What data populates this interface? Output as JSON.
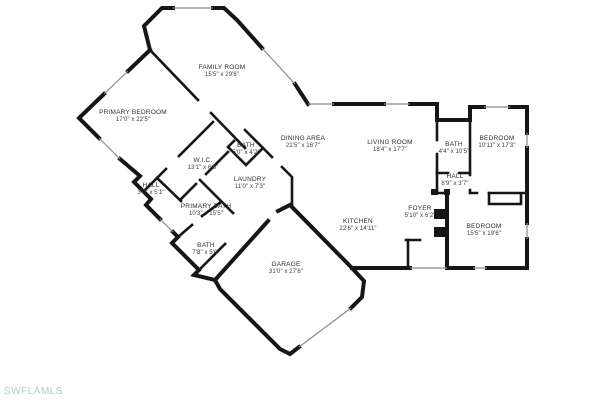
{
  "page": {
    "background": "#ffffff",
    "type_note": "residential floor plan drawing"
  },
  "colors": {
    "walls": "#161616",
    "windows_doors": "#8a8a8a",
    "label_text": "#2d2d2d",
    "watermark": "#aecfca"
  },
  "watermark": {
    "text": "SWFLAMLS"
  },
  "plan": {
    "rooms": [
      {
        "name": "FAMILY ROOM",
        "dims": "15'5\" x 29'6\"",
        "x": 222,
        "y": 72
      },
      {
        "name": "PRIMARY BEDROOM",
        "dims": "17'0\" x 22'5\"",
        "x": 133,
        "y": 117
      },
      {
        "name": "DINING AREA",
        "dims": "21'5\" x 16'7\"",
        "x": 303,
        "y": 143
      },
      {
        "name": "LIVING ROOM",
        "dims": "18'4\" x 17'7\"",
        "x": 390,
        "y": 147
      },
      {
        "name": "BATH",
        "dims": "5'0\" x 4'2\"",
        "x": 246,
        "y": 150
      },
      {
        "name": "W.I.C.",
        "dims": "13'1\" x 6'5\"",
        "x": 203,
        "y": 165
      },
      {
        "name": "LAUNDRY",
        "dims": "11'0\" x 7'3\"",
        "x": 250,
        "y": 184
      },
      {
        "name": "HALL",
        "dims": "3'7\" x 5'1\"",
        "x": 151,
        "y": 190
      },
      {
        "name": "PRIMARY BATH",
        "dims": "10'3\" x 15'5\"",
        "x": 206,
        "y": 211
      },
      {
        "name": "BATH",
        "dims": "7'8\" x 5'0\"",
        "x": 206,
        "y": 250
      },
      {
        "name": "GARAGE",
        "dims": "31'0\" x 27'6\"",
        "x": 286,
        "y": 269
      },
      {
        "name": "KITCHEN",
        "dims": "22'6\" x 14'11\"",
        "x": 358,
        "y": 226
      },
      {
        "name": "FOYER",
        "dims": "5'10\" x 6'2\"",
        "x": 420,
        "y": 213
      },
      {
        "name": "BATH",
        "dims": "4'4\" x 10'5\"",
        "x": 454,
        "y": 149
      },
      {
        "name": "HALL",
        "dims": "8'9\" x 3'7\"",
        "x": 455,
        "y": 181
      },
      {
        "name": "BEDROOM",
        "dims": "10'11\" x 17'3\"",
        "x": 497,
        "y": 143
      },
      {
        "name": "BEDROOM",
        "dims": "15'5\" x 19'6\"",
        "x": 484,
        "y": 231
      }
    ]
  }
}
